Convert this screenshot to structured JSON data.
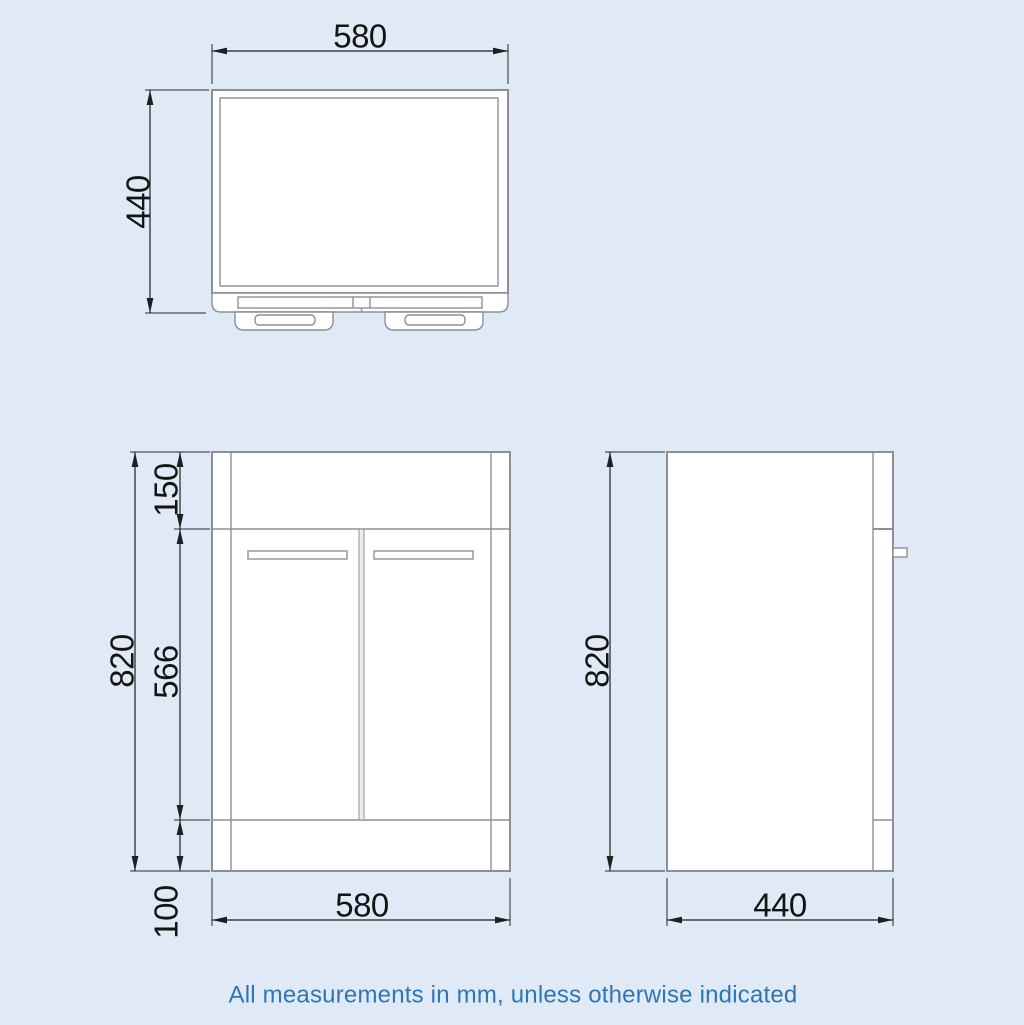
{
  "page": {
    "background": "#dfeaf6",
    "drawing_line_color": "#8c9096",
    "dimension_color": "#1f1f1f"
  },
  "views": {
    "top": {
      "title": "top-plan-view",
      "dim_width": {
        "label": "580"
      },
      "dim_depth": {
        "label": "440"
      }
    },
    "front": {
      "title": "front-view",
      "dim_height_total": {
        "label": "820"
      },
      "dim_top_section": {
        "label": "150"
      },
      "dim_door_height": {
        "label": "566"
      },
      "dim_plinth_height": {
        "label": "100"
      },
      "dim_width": {
        "label": "580"
      }
    },
    "side": {
      "title": "side-view",
      "dim_height_total": {
        "label": "820"
      },
      "dim_depth": {
        "label": "440"
      }
    }
  },
  "footer": {
    "note": "All measurements in mm, unless otherwise indicated",
    "color": "#2e75b4"
  }
}
